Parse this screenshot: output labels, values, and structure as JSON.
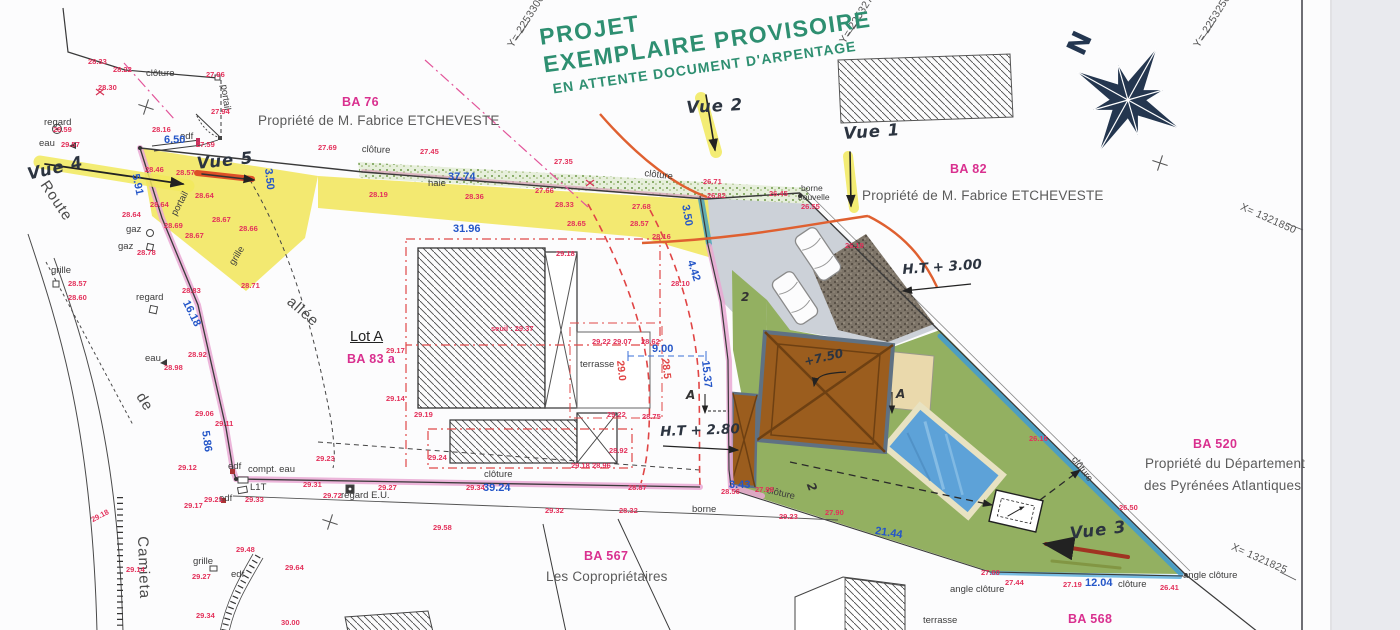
{
  "note": {
    "line1": "PROJET",
    "line2": "EXEMPLAIRE PROVISOIRE",
    "line3": "EN ATTENTE DOCUMENT D'ARPENTAGE"
  },
  "north_label": "N",
  "parcels": {
    "ba76": {
      "id": "BA 76",
      "owner": "Propriété de M. Fabrice ETCHEVESTE"
    },
    "ba82": {
      "id": "BA 82",
      "owner": "Propriété de M. Fabrice ETCHEVESTE"
    },
    "ba520": {
      "id": "BA 520",
      "owner_line1": "Propriété du Département",
      "owner_line2": "des Pyrénées Atlantiques"
    },
    "ba567": {
      "id": "BA 567",
      "owner": "Les Copropriétaires"
    },
    "ba568": {
      "id": "BA 568"
    },
    "lot_a": {
      "name": "Lot A",
      "id": "BA 83 a"
    }
  },
  "views": {
    "v1": "Vue 1",
    "v2": "Vue 2",
    "v3": "Vue 3",
    "v4": "Vue 4",
    "v5": "Vue 5"
  },
  "annotations": {
    "ht280": "H.T + 2.80",
    "ht300": "H.T + 3.00",
    "ridge": "+7.50"
  },
  "colors": {
    "note_green": "#2e8f71",
    "parcel_magenta": "#d9308f",
    "spot_red": "#e3315b",
    "dimension_blue": "#2456c8",
    "highlight_yellow": "#f2e765",
    "highlight_pink": "#e9a8d4",
    "lawn_green": "#93b061",
    "roof_brown": "#9b5d1e",
    "pool_blue": "#5da2d8",
    "compass_navy": "#24364f"
  },
  "map_labels": [
    [
      "clôture",
      146,
      69,
      "g"
    ],
    [
      "portail",
      228,
      84,
      "g",
      82
    ],
    [
      "regard",
      44,
      118,
      "g"
    ],
    [
      "eau",
      39,
      139,
      "g"
    ],
    [
      "edf",
      180,
      132,
      "g"
    ],
    [
      "gaz",
      126,
      225,
      "g"
    ],
    [
      "gaz",
      118,
      242,
      "g"
    ],
    [
      "grille",
      51,
      266,
      "g"
    ],
    [
      "portail",
      170,
      213,
      "g",
      -62
    ],
    [
      "grille",
      228,
      262,
      "g",
      -58
    ],
    [
      "regard",
      136,
      293,
      "g"
    ],
    [
      "eau",
      145,
      354,
      "g"
    ],
    [
      "clôture",
      362,
      145,
      "g",
      2
    ],
    [
      "haie",
      428,
      179,
      "g"
    ],
    [
      "clôture",
      645,
      169,
      "g",
      7
    ],
    [
      "borne",
      801,
      184,
      "m"
    ],
    [
      "nouvelle",
      798,
      193,
      "m"
    ],
    [
      "terrasse",
      580,
      360,
      "g"
    ],
    [
      "compt. eau",
      248,
      465,
      "g"
    ],
    [
      "L1T",
      250,
      483,
      "g"
    ],
    [
      "regard E.U.",
      341,
      491,
      "g"
    ],
    [
      "edf",
      228,
      462,
      "g"
    ],
    [
      "edf",
      219,
      494,
      "g"
    ],
    [
      "grille",
      193,
      557,
      "g"
    ],
    [
      "edf",
      231,
      570,
      "g"
    ],
    [
      "borne",
      692,
      505,
      "g"
    ],
    [
      "clôture",
      484,
      470,
      "g"
    ],
    [
      "clôture",
      768,
      486,
      "g",
      13
    ],
    [
      "clôture",
      1077,
      455,
      "g",
      53
    ],
    [
      "angle clôture",
      950,
      585,
      "g"
    ],
    [
      "angle clôture",
      1183,
      571,
      "g"
    ],
    [
      "terrasse",
      923,
      616,
      "g"
    ],
    [
      "clôture",
      1118,
      580,
      "g"
    ],
    [
      "Route",
      50,
      178,
      "G",
      56
    ],
    [
      "de",
      146,
      390,
      "G",
      58
    ],
    [
      "Camieta",
      150,
      536,
      "G",
      88
    ],
    [
      "allée",
      294,
      294,
      "G",
      41
    ],
    [
      "Y= 2253300",
      506,
      44,
      "x",
      -58
    ],
    [
      "Y= 2253275",
      838,
      40,
      "x",
      -58
    ],
    [
      "Y= 2253250",
      1192,
      44,
      "x",
      -58
    ],
    [
      "X= 1321850",
      1243,
      202,
      "x",
      24
    ],
    [
      "X= 1321825",
      1234,
      542,
      "x",
      24
    ],
    [
      "6.50",
      164,
      135,
      "b"
    ],
    [
      "5.91",
      140,
      173,
      "b",
      78
    ],
    [
      "3.50",
      273,
      168,
      "b",
      84
    ],
    [
      "37.74",
      448,
      172,
      "b"
    ],
    [
      "31.96",
      453,
      224,
      "b"
    ],
    [
      "16.18",
      190,
      299,
      "b",
      64
    ],
    [
      "5.86",
      210,
      430,
      "b",
      82
    ],
    [
      "39.24",
      483,
      483,
      "b"
    ],
    [
      "9.00",
      652,
      344,
      "b"
    ],
    [
      "15.37",
      710,
      360,
      "b",
      84
    ],
    [
      "3.50",
      690,
      204,
      "b",
      80
    ],
    [
      "4.42",
      695,
      259,
      "b",
      72
    ],
    [
      "3.43",
      729,
      480,
      "b"
    ],
    [
      "12.04",
      1085,
      578,
      "b"
    ],
    [
      "21.44",
      876,
      526,
      "b",
      9
    ],
    [
      "29.0",
      625,
      360,
      "rc",
      84
    ],
    [
      "28.5",
      670,
      358,
      "rc",
      84
    ],
    [
      "28.33",
      88,
      58,
      "r"
    ],
    [
      "28.22",
      113,
      66,
      "r"
    ],
    [
      "28.30",
      98,
      84,
      "r"
    ],
    [
      "27.96",
      206,
      71,
      "r"
    ],
    [
      "27.94",
      211,
      108,
      "r"
    ],
    [
      "28.59",
      53,
      126,
      "r"
    ],
    [
      "29.57",
      61,
      141,
      "r"
    ],
    [
      "28.16",
      152,
      126,
      "r"
    ],
    [
      "27.59",
      196,
      141,
      "r"
    ],
    [
      "28.46",
      145,
      166,
      "r"
    ],
    [
      "28.57",
      176,
      169,
      "r"
    ],
    [
      "28.64",
      195,
      192,
      "r"
    ],
    [
      "28.64",
      150,
      201,
      "r"
    ],
    [
      "28.64",
      122,
      211,
      "r"
    ],
    [
      "28.67",
      212,
      216,
      "r"
    ],
    [
      "28.69",
      164,
      222,
      "r"
    ],
    [
      "28.67",
      185,
      232,
      "r"
    ],
    [
      "28.66",
      239,
      225,
      "r"
    ],
    [
      "28.78",
      137,
      249,
      "r"
    ],
    [
      "28.57",
      68,
      280,
      "r"
    ],
    [
      "28.60",
      68,
      294,
      "r"
    ],
    [
      "28.71",
      241,
      282,
      "r"
    ],
    [
      "28.83",
      182,
      287,
      "r"
    ],
    [
      "28.92",
      188,
      351,
      "r"
    ],
    [
      "28.98",
      164,
      364,
      "r"
    ],
    [
      "29.06",
      195,
      410,
      "r"
    ],
    [
      "29.11",
      215,
      420,
      "r"
    ],
    [
      "29.12",
      178,
      464,
      "r"
    ],
    [
      "29.17",
      184,
      502,
      "r"
    ],
    [
      "29.23",
      204,
      496,
      "r"
    ],
    [
      "29.33",
      245,
      496,
      "r"
    ],
    [
      "29.31",
      303,
      481,
      "r"
    ],
    [
      "29.72",
      323,
      492,
      "r"
    ],
    [
      "29.27",
      378,
      484,
      "r"
    ],
    [
      "29.34",
      466,
      484,
      "r"
    ],
    [
      "29.58",
      433,
      524,
      "r"
    ],
    [
      "29.23",
      316,
      455,
      "r"
    ],
    [
      "29.24",
      428,
      454,
      "r"
    ],
    [
      "28.87",
      628,
      484,
      "r"
    ],
    [
      "29.14",
      126,
      566,
      "r"
    ],
    [
      "29.48",
      236,
      546,
      "r"
    ],
    [
      "29.64",
      285,
      564,
      "r"
    ],
    [
      "29.27",
      192,
      573,
      "r"
    ],
    [
      "29.34",
      196,
      612,
      "r"
    ],
    [
      "30.00",
      281,
      619,
      "r"
    ],
    [
      "29.18",
      90,
      517,
      "r",
      -28
    ],
    [
      "27.69",
      318,
      144,
      "r"
    ],
    [
      "27.45",
      420,
      148,
      "r"
    ],
    [
      "27.35",
      554,
      158,
      "r"
    ],
    [
      "27.66",
      535,
      187,
      "r"
    ],
    [
      "28.19",
      369,
      191,
      "r"
    ],
    [
      "28.36",
      465,
      193,
      "r"
    ],
    [
      "28.33",
      555,
      201,
      "r"
    ],
    [
      "27.68",
      632,
      203,
      "r"
    ],
    [
      "28.65",
      567,
      220,
      "r"
    ],
    [
      "28.57",
      630,
      220,
      "r"
    ],
    [
      "28.16",
      652,
      233,
      "r"
    ],
    [
      "29.18",
      556,
      250,
      "r"
    ],
    [
      "26.71",
      703,
      178,
      "r"
    ],
    [
      "26.82",
      707,
      192,
      "r"
    ],
    [
      "26.45",
      769,
      190,
      "r"
    ],
    [
      "26.55",
      801,
      203,
      "r"
    ],
    [
      "26.19",
      845,
      242,
      "r"
    ],
    [
      "28.10",
      671,
      280,
      "r"
    ],
    [
      "29.17",
      386,
      347,
      "r"
    ],
    [
      "29.14",
      386,
      395,
      "r"
    ],
    [
      "29.19",
      414,
      411,
      "r"
    ],
    [
      "29.22",
      592,
      338,
      "r"
    ],
    [
      "29.07",
      613,
      338,
      "r"
    ],
    [
      "28.62",
      641,
      338,
      "r"
    ],
    [
      "29.22",
      607,
      411,
      "r"
    ],
    [
      "28.75",
      642,
      413,
      "r"
    ],
    [
      "28.92",
      609,
      447,
      "r"
    ],
    [
      "29.18",
      571,
      462,
      "r"
    ],
    [
      "28.96",
      592,
      462,
      "r"
    ],
    [
      "28.56",
      721,
      488,
      "r"
    ],
    [
      "27.98",
      755,
      486,
      "r"
    ],
    [
      "29.32",
      545,
      507,
      "r"
    ],
    [
      "28.32",
      619,
      507,
      "r"
    ],
    [
      "29.23",
      779,
      513,
      "r"
    ],
    [
      "27.90",
      825,
      509,
      "r"
    ],
    [
      "26.16",
      1029,
      435,
      "r"
    ],
    [
      "26.50",
      1119,
      504,
      "r"
    ],
    [
      "27.60",
      981,
      569,
      "r"
    ],
    [
      "27.44",
      1005,
      579,
      "r"
    ],
    [
      "27.19",
      1063,
      581,
      "r"
    ],
    [
      "26.41",
      1160,
      584,
      "r"
    ],
    [
      "seuil : 29.37",
      491,
      325,
      "r"
    ],
    [
      "2",
      741,
      291,
      "h"
    ],
    [
      "2",
      816,
      481,
      "h",
      70
    ],
    [
      "A",
      686,
      389,
      "h"
    ],
    [
      "A",
      896,
      388,
      "h"
    ]
  ]
}
